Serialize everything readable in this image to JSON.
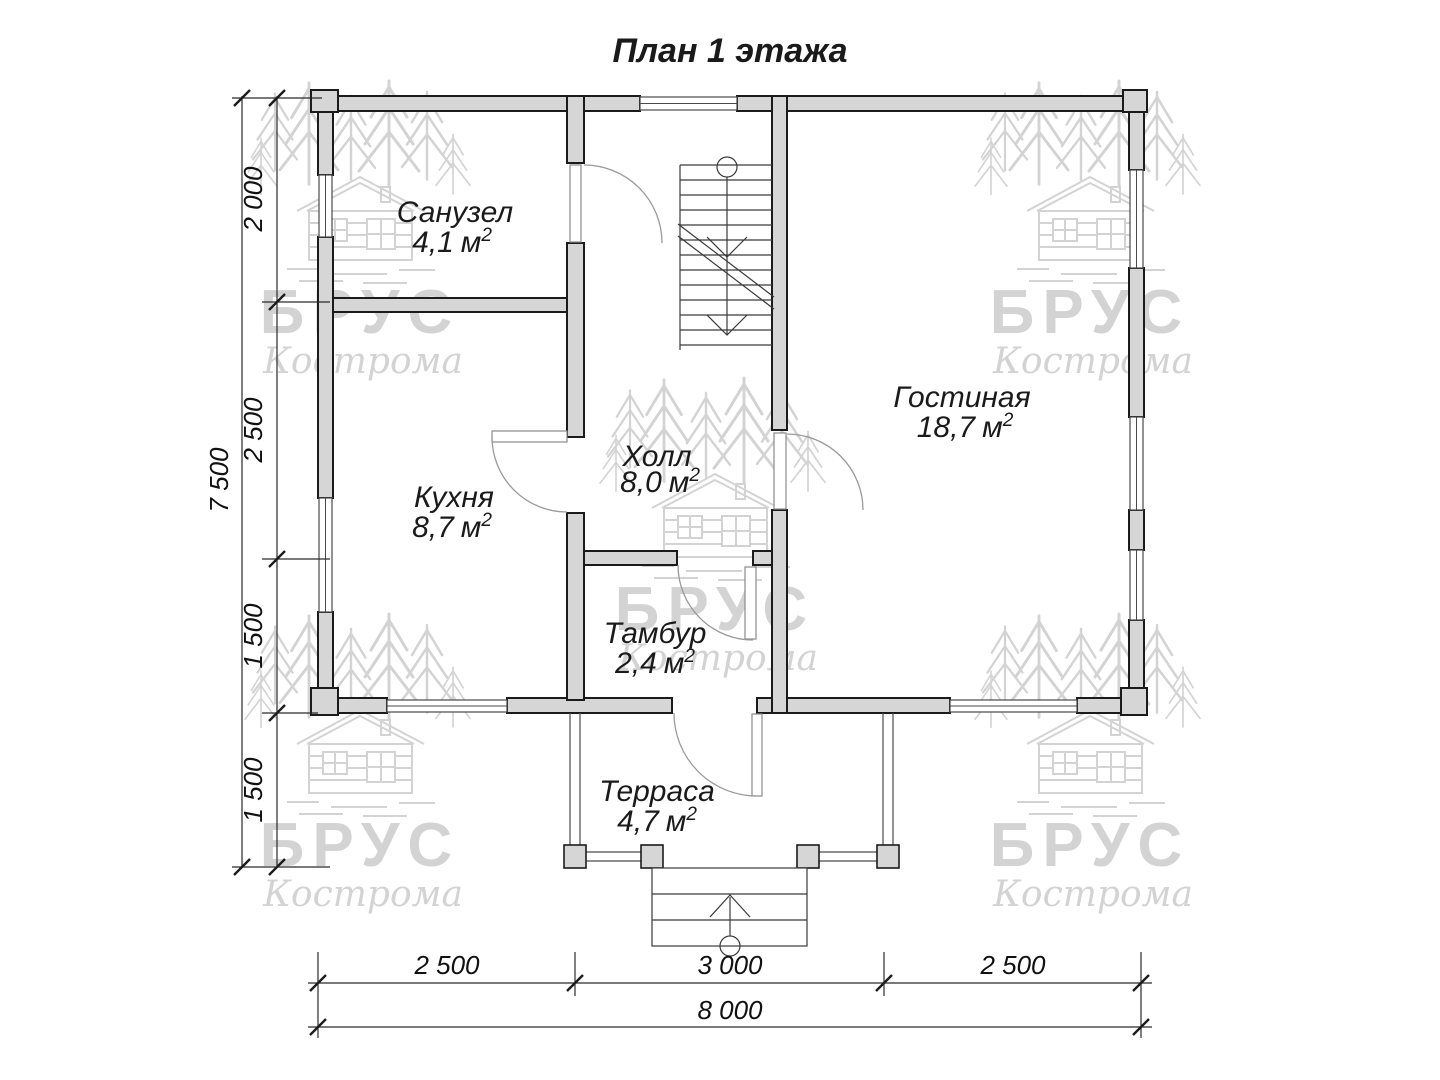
{
  "title": "План 1 этажа",
  "watermark": {
    "brand": "БРУС",
    "city": "Кострома"
  },
  "rooms": [
    {
      "id": "sanuzel",
      "name": "Санузел",
      "area": "4,1"
    },
    {
      "id": "gostinaya",
      "name": "Гостиная",
      "area": "18,7"
    },
    {
      "id": "kuhnya",
      "name": "Кухня",
      "area": "8,7"
    },
    {
      "id": "holl",
      "name": "Холл",
      "area": "8,0"
    },
    {
      "id": "tambur",
      "name": "Тамбур",
      "area": "2,4"
    },
    {
      "id": "terrasa",
      "name": "Терраса",
      "area": "4,7"
    }
  ],
  "units": {
    "area_symbol": "м",
    "area_power": "2"
  },
  "dimensions": {
    "left": {
      "total": "7 500",
      "segments": [
        "2 000",
        "2 500",
        "1 500",
        "1 500"
      ]
    },
    "bottom": {
      "total": "8 000",
      "segments": [
        "2 500",
        "3 000",
        "2 500"
      ]
    }
  },
  "colors": {
    "background": "#ffffff",
    "wall_fill": "#d6d6d6",
    "wall_outline": "#1b1b1b",
    "thin_line": "#4a4a4a",
    "door_arc": "#9a9a9a",
    "dimension_line": "#2a2a2a",
    "watermark": "#cccccc",
    "text": "#1a1a1a"
  }
}
